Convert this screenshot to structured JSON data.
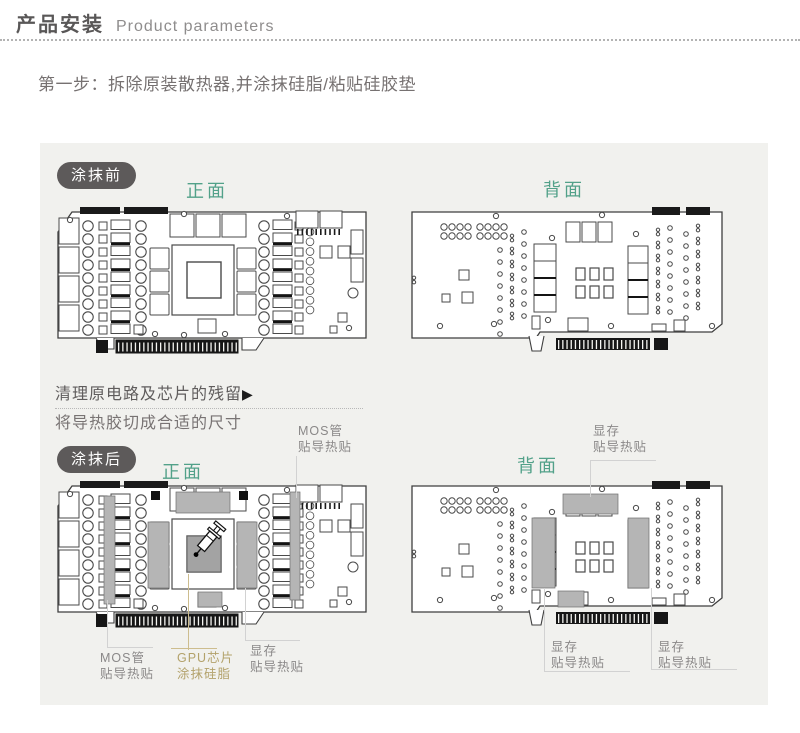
{
  "header": {
    "title": "产品安装",
    "subtitle": "Product parameters"
  },
  "step": {
    "text": "第一步：拆除原装散热器,并涂抹硅脂/粘贴硅胶垫"
  },
  "panel": {
    "before": {
      "badge": "涂抹前",
      "front_label": "正面",
      "back_label": "背面"
    },
    "note": {
      "line1": "清理原电路及芯片的残留",
      "arrow": "▶",
      "line2": "将导热胶切成合适的尺寸"
    },
    "after": {
      "badge": "涂抹后",
      "front_label": "正面",
      "back_label": "背面"
    },
    "annotations": {
      "front_mos_top": {
        "line1": "MOS管",
        "line2": "贴导热贴"
      },
      "back_mem_top": {
        "line1": "显存",
        "line2": "贴导热贴"
      },
      "front_mos_bottom": {
        "line1": "MOS管",
        "line2": "贴导热贴"
      },
      "front_gpu_bottom": {
        "line1": "GPU芯片",
        "line2": "涂抹硅脂"
      },
      "front_mem_bottom": {
        "line1": "显存",
        "line2": "贴导热贴"
      },
      "back_mem_bottom_left": {
        "line1": "显存",
        "line2": "贴导热贴"
      },
      "back_mem_bottom_right": {
        "line1": "显存",
        "line2": "贴导热贴"
      }
    }
  },
  "colors": {
    "accent_green": "#52a189",
    "badge_bg": "#5d5a5a",
    "annotation_gold": "#b3a26b",
    "thermal_pad_gray": "#b5b5b5"
  }
}
